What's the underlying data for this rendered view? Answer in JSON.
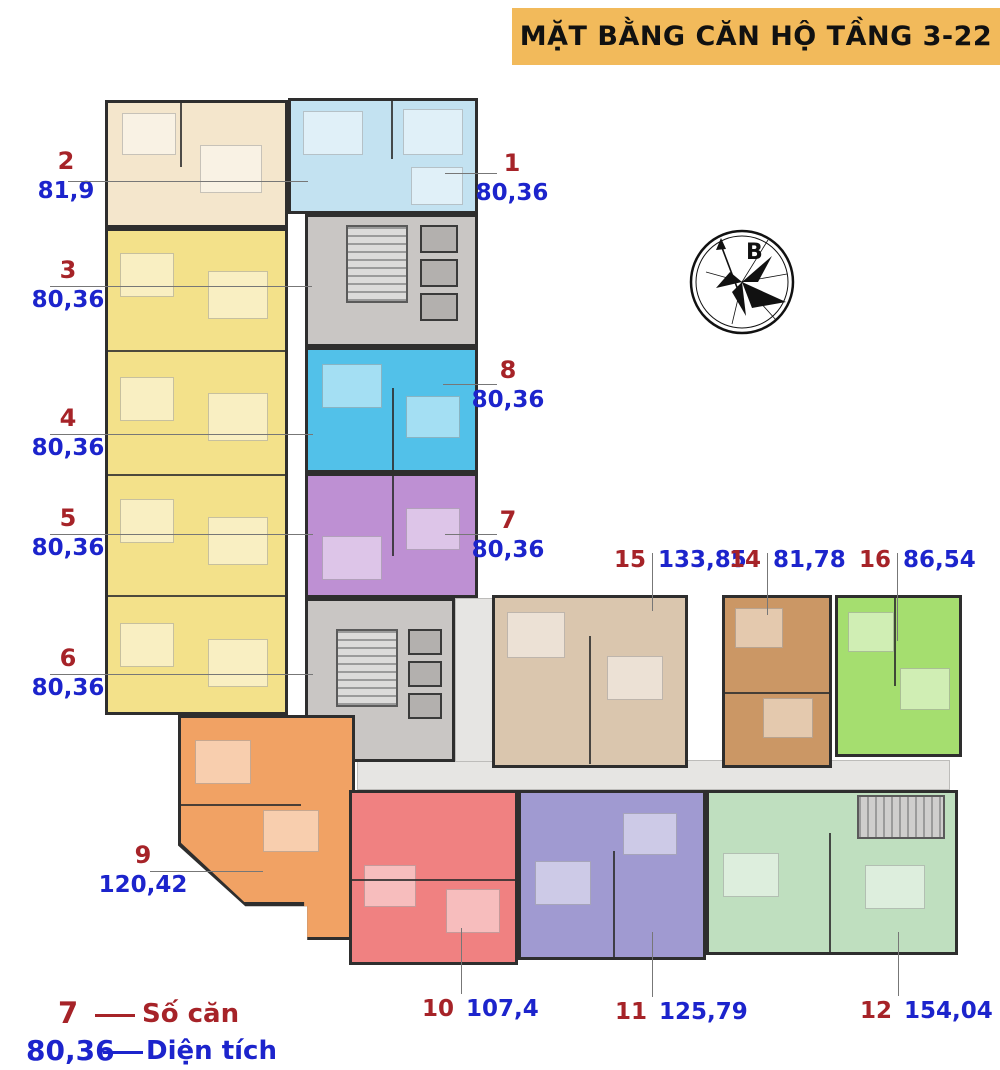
{
  "title": "MẶT BẰNG CĂN HỘ TẦNG 3-22",
  "compass": {
    "north_label": "B"
  },
  "legend": {
    "number_example": "7",
    "number_label": "Số căn",
    "area_example": "80,36",
    "area_label": "Diện tích"
  },
  "units": [
    {
      "no": "1",
      "area": "80,36"
    },
    {
      "no": "2",
      "area": "81,9"
    },
    {
      "no": "3",
      "area": "80,36"
    },
    {
      "no": "4",
      "area": "80,36"
    },
    {
      "no": "5",
      "area": "80,36"
    },
    {
      "no": "6",
      "area": "80,36"
    },
    {
      "no": "7",
      "area": "80,36"
    },
    {
      "no": "8",
      "area": "80,36"
    },
    {
      "no": "9",
      "area": "120,42"
    },
    {
      "no": "10",
      "area": "107,4"
    },
    {
      "no": "11",
      "area": "125,79"
    },
    {
      "no": "12",
      "area": "154,04"
    },
    {
      "no": "14",
      "area": "81,78"
    },
    {
      "no": "15",
      "area": "133,85"
    },
    {
      "no": "16",
      "area": "86,54"
    }
  ],
  "colors": {
    "banner_bg": "#f2ba5b",
    "unit_number_text": "#a62328",
    "area_text": "#1c24cc",
    "wall": "#2e2e2e",
    "core_gray": "#c9c6c4",
    "corridor_gray": "#e6e5e3",
    "units": {
      "u1": "#c3e2f1",
      "u2": "#f4e6cc",
      "u3_6": "#f3e18a",
      "u7": "#be90d3",
      "u8": "#52c1e9",
      "u9": "#f1a264",
      "u10": "#f08181",
      "u11": "#a09ad1",
      "u12": "#bfdfbf",
      "u14": "#cb9765",
      "u15": "#dac6ae",
      "u16": "#a5de6f"
    }
  }
}
